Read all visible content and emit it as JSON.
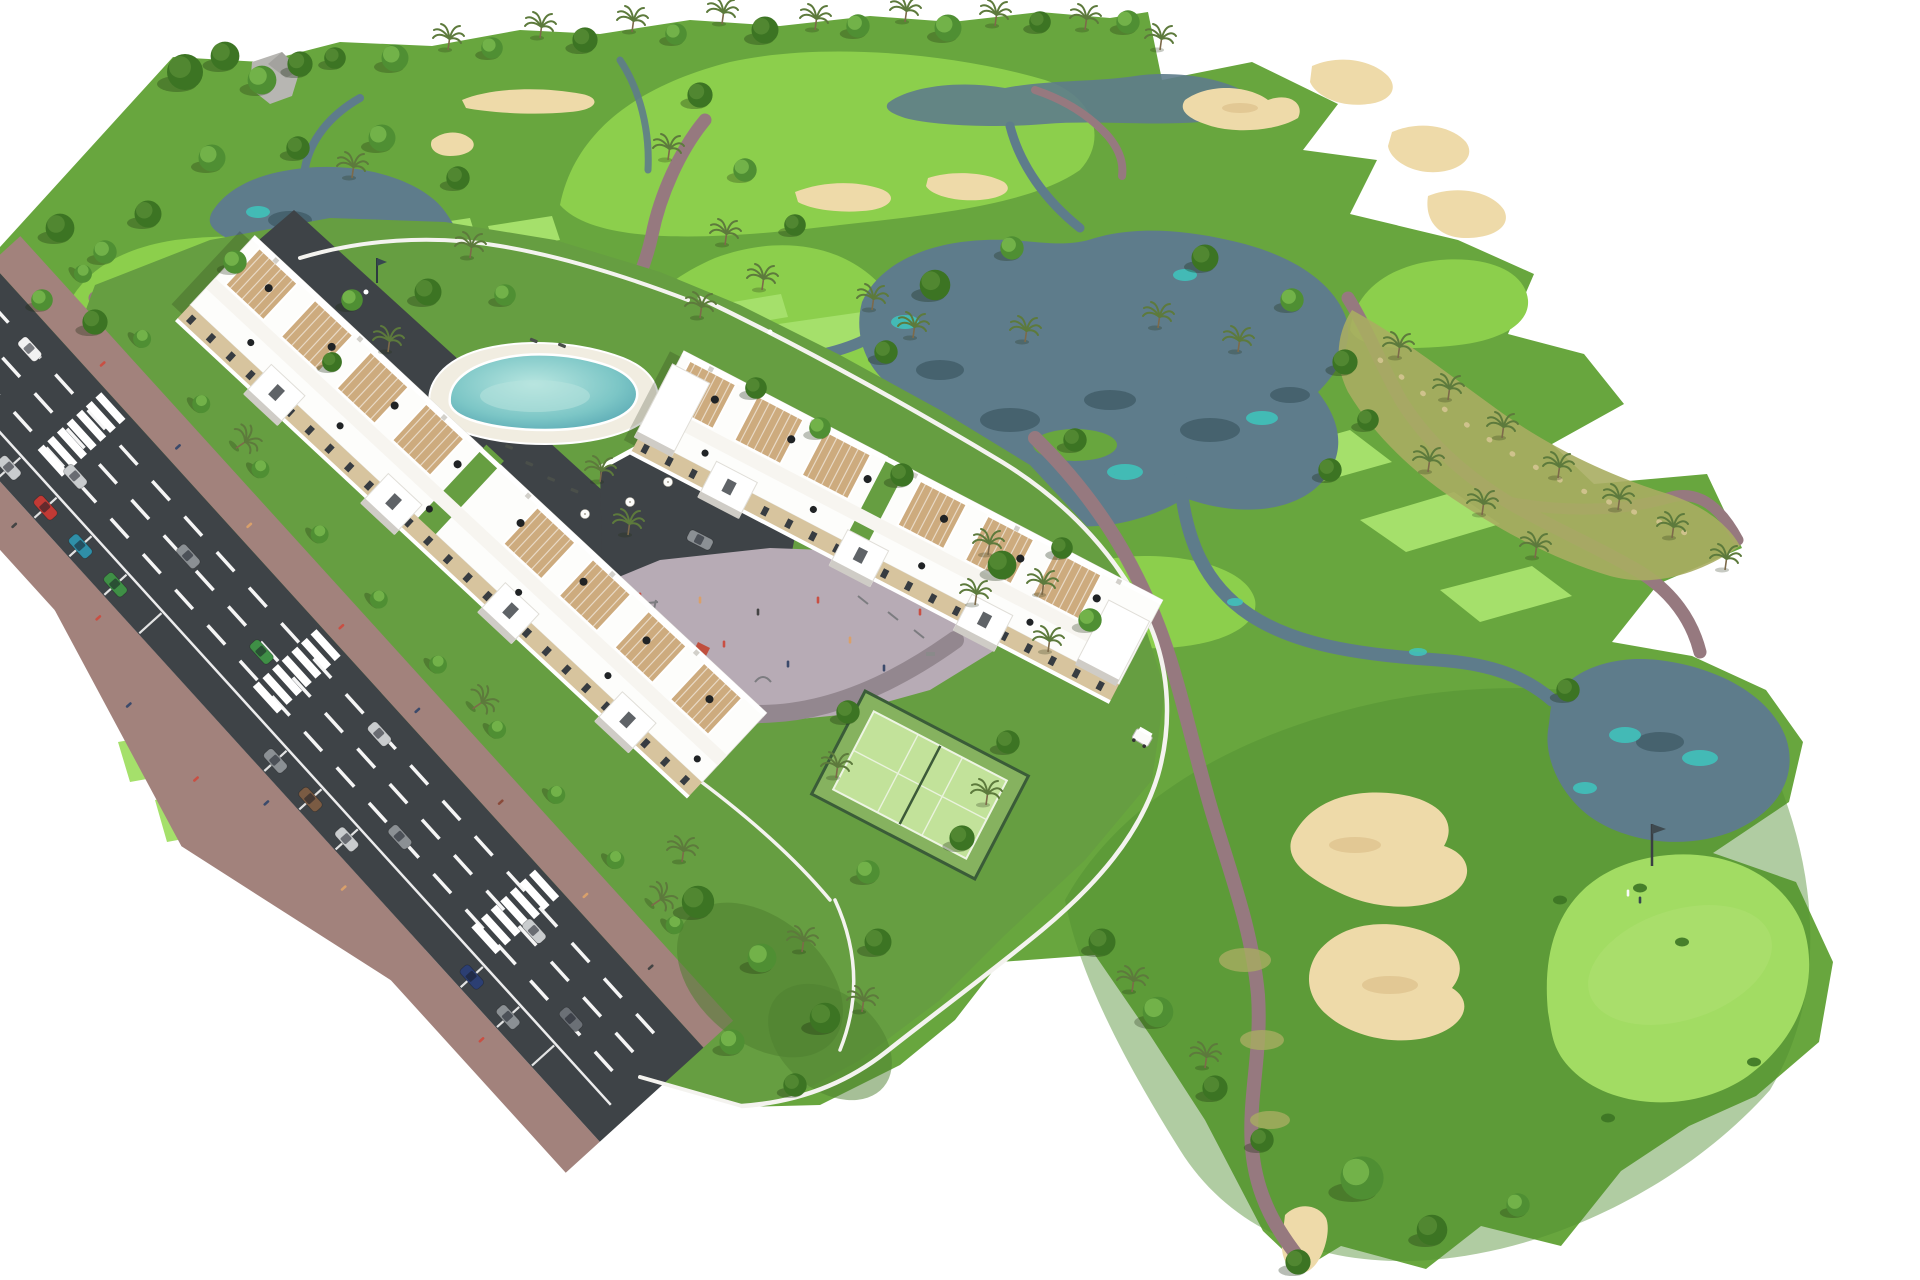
{
  "image": {
    "alt": "Aerial 3D architectural rendering of a white resort apartment complex with swimming pool, playground and padel court, next to a golf course with lakes, sand bunkers, cart paths, palm trees and a flagged putting green",
    "background": "#ffffff"
  },
  "colors": {
    "bg": "#ffffff",
    "rough": "#68a63e",
    "roughDeep": "#4f8f30",
    "fairway": "#8ccf4c",
    "fairwayLight": "#a2dc63",
    "tee": "#a5e06b",
    "complexLawn": "#669e41",
    "water": "#5e7c8b",
    "waterTeal": "#3ec6bd",
    "reflection": "#46626e",
    "sand": "#eedaa9",
    "sandDark": "#ddc08b",
    "path": "#96797f",
    "road": "#3e4347",
    "sidewalk": "#a2827c",
    "marking": "#ffffff",
    "wall": "#f4f3ef",
    "facade": "#d7c49e",
    "terrace": "#cdab7e",
    "windowDark": "#373c41",
    "poolDeck": "#f1ede1",
    "plaza": "#b7abb5",
    "plazaPath": "#93878f",
    "court": "#c2e29a",
    "courtFence": "#3a5c38",
    "tree": "#4f8f33",
    "treeLight": "#7dbd52",
    "treeDark": "#3c7423",
    "treeDarkLight": "#568c35",
    "palm": "#5d7a3c",
    "dry": "#a8ad62",
    "drySpeckle": "#cfc28c"
  },
  "scene": {
    "areas": [
      "golf-course",
      "apartment-complex",
      "access-road"
    ],
    "golf": {
      "lakes": 4,
      "bunker_clusters": 6,
      "tee_boxes": 9,
      "greens_with_flag": 2,
      "cart_paths": 3
    },
    "complex": {
      "apartment_buildings": 2,
      "swimming_pool": 1,
      "padel_court": 1,
      "playground": 1,
      "entry_gate": 1,
      "golf_cart": 1
    },
    "road": {
      "lanes": 2,
      "crosswalks": 3,
      "parked_cars": 11,
      "moving_cars": 8
    }
  }
}
